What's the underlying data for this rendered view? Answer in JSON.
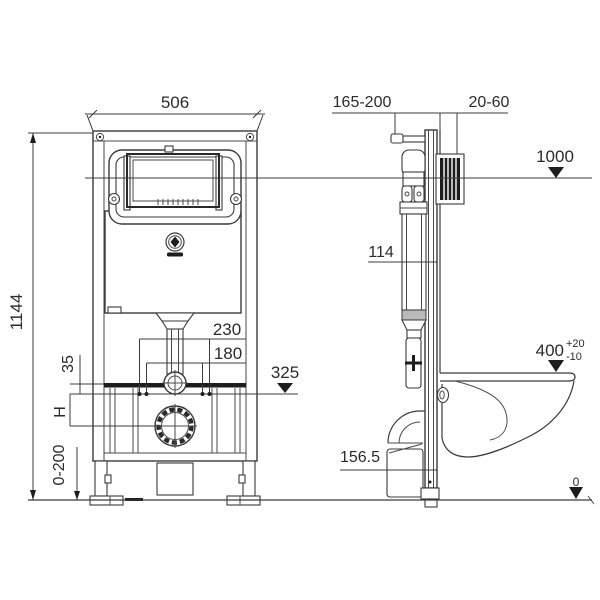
{
  "colors": {
    "background": "#ffffff",
    "line": "#3a3a3a",
    "text": "#2b2b2b",
    "solid_fill": "#1d1d1d"
  },
  "labels": {
    "front_width": "506",
    "front_height": "1144",
    "pipe_offset_outer": "230",
    "pipe_offset_inner": "180",
    "flush_bend_level": "325",
    "offset_small": "35",
    "height_h": "H",
    "leg_adjust": "0-200",
    "depth_range": "165-200",
    "wall_gap": "20-60",
    "button_level": "1000",
    "rail_depth": "114",
    "bowl_height": "400",
    "bowl_tol_plus": "+20",
    "bowl_tol_minus": "-10",
    "drain_level": "156.5",
    "floor_level": "0"
  }
}
